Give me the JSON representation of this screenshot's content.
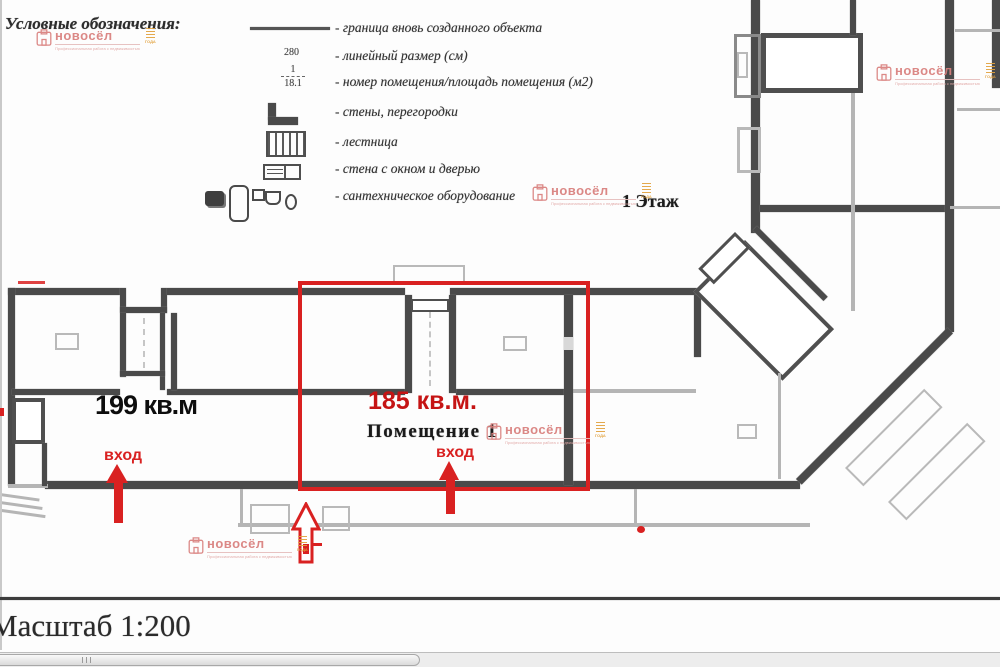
{
  "legend": {
    "title": "Условные обозначения:",
    "items": [
      {
        "label": "- граница вновь созданного объекта"
      },
      {
        "symbol_text": "280",
        "label": "- линейный размер (см)"
      },
      {
        "numerator": "1",
        "denominator": "18.1",
        "label": "- номер помещения/площадь помещения (м2)"
      },
      {
        "label": "- стены, перегородки"
      },
      {
        "label": "- лестница"
      },
      {
        "label": "- стена с окном и дверью"
      },
      {
        "label": "- сантехническое оборудование"
      }
    ]
  },
  "plan": {
    "floor_label": "1 Этаж",
    "left_room_area": "199 кв.м",
    "highlighted_room_area": "185 кв.м.",
    "highlighted_room_name": "Помещение 1",
    "entrance_label_left": "вход",
    "entrance_label_center": "вход"
  },
  "footer": {
    "scale_label": "Масштаб 1:200"
  },
  "watermark": {
    "brand": "новосёл",
    "tagline": "Профессиональная работа с недвижимостью",
    "badge": "ГОДА"
  },
  "colors": {
    "annotation_red": "#d92121",
    "area_red": "#c51414",
    "wall_dark": "#4a4a4a",
    "wall_light": "#b5b5b5",
    "watermark_pink": "#d97f7c",
    "watermark_orange": "#e2a23f"
  }
}
